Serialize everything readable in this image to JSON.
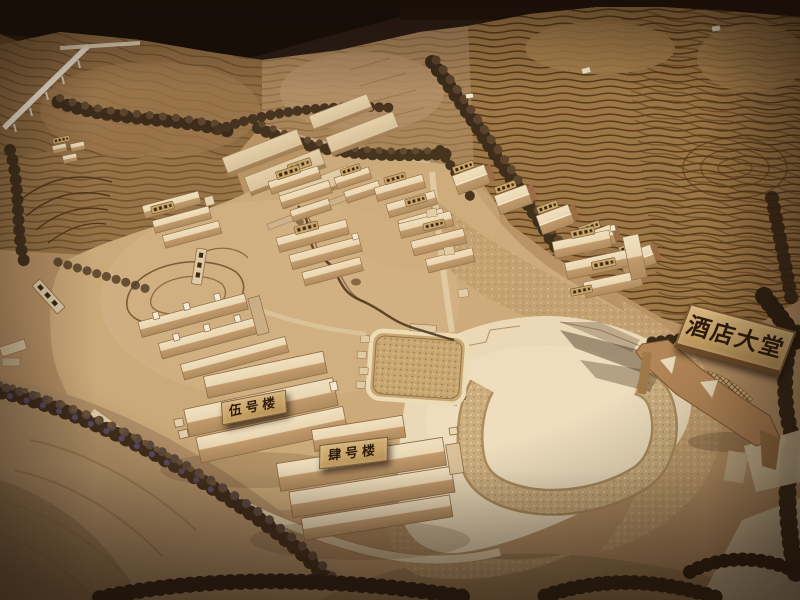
{
  "signs": {
    "hotel_lobby": {
      "text": "酒店大堂"
    },
    "building_5": {
      "text": "伍号楼"
    },
    "building_4": {
      "text": "肆号楼"
    }
  },
  "palette": {
    "backdrop_dark": "#1c110b",
    "wood_floor": "#7b522f",
    "model_board": "#b89266",
    "terraced_hill": "#9c7645",
    "contour_line": "#4e3114",
    "site_ground": "#cbaa7a",
    "plaza_plywood": "#ead9b8",
    "building_wood_light": "#e9d6b2",
    "building_wood_shade": "#ad8a5e",
    "trees_dark": "#3b2a19",
    "sign_board": "#c8a468",
    "sign_text": "#2b1a0c"
  }
}
